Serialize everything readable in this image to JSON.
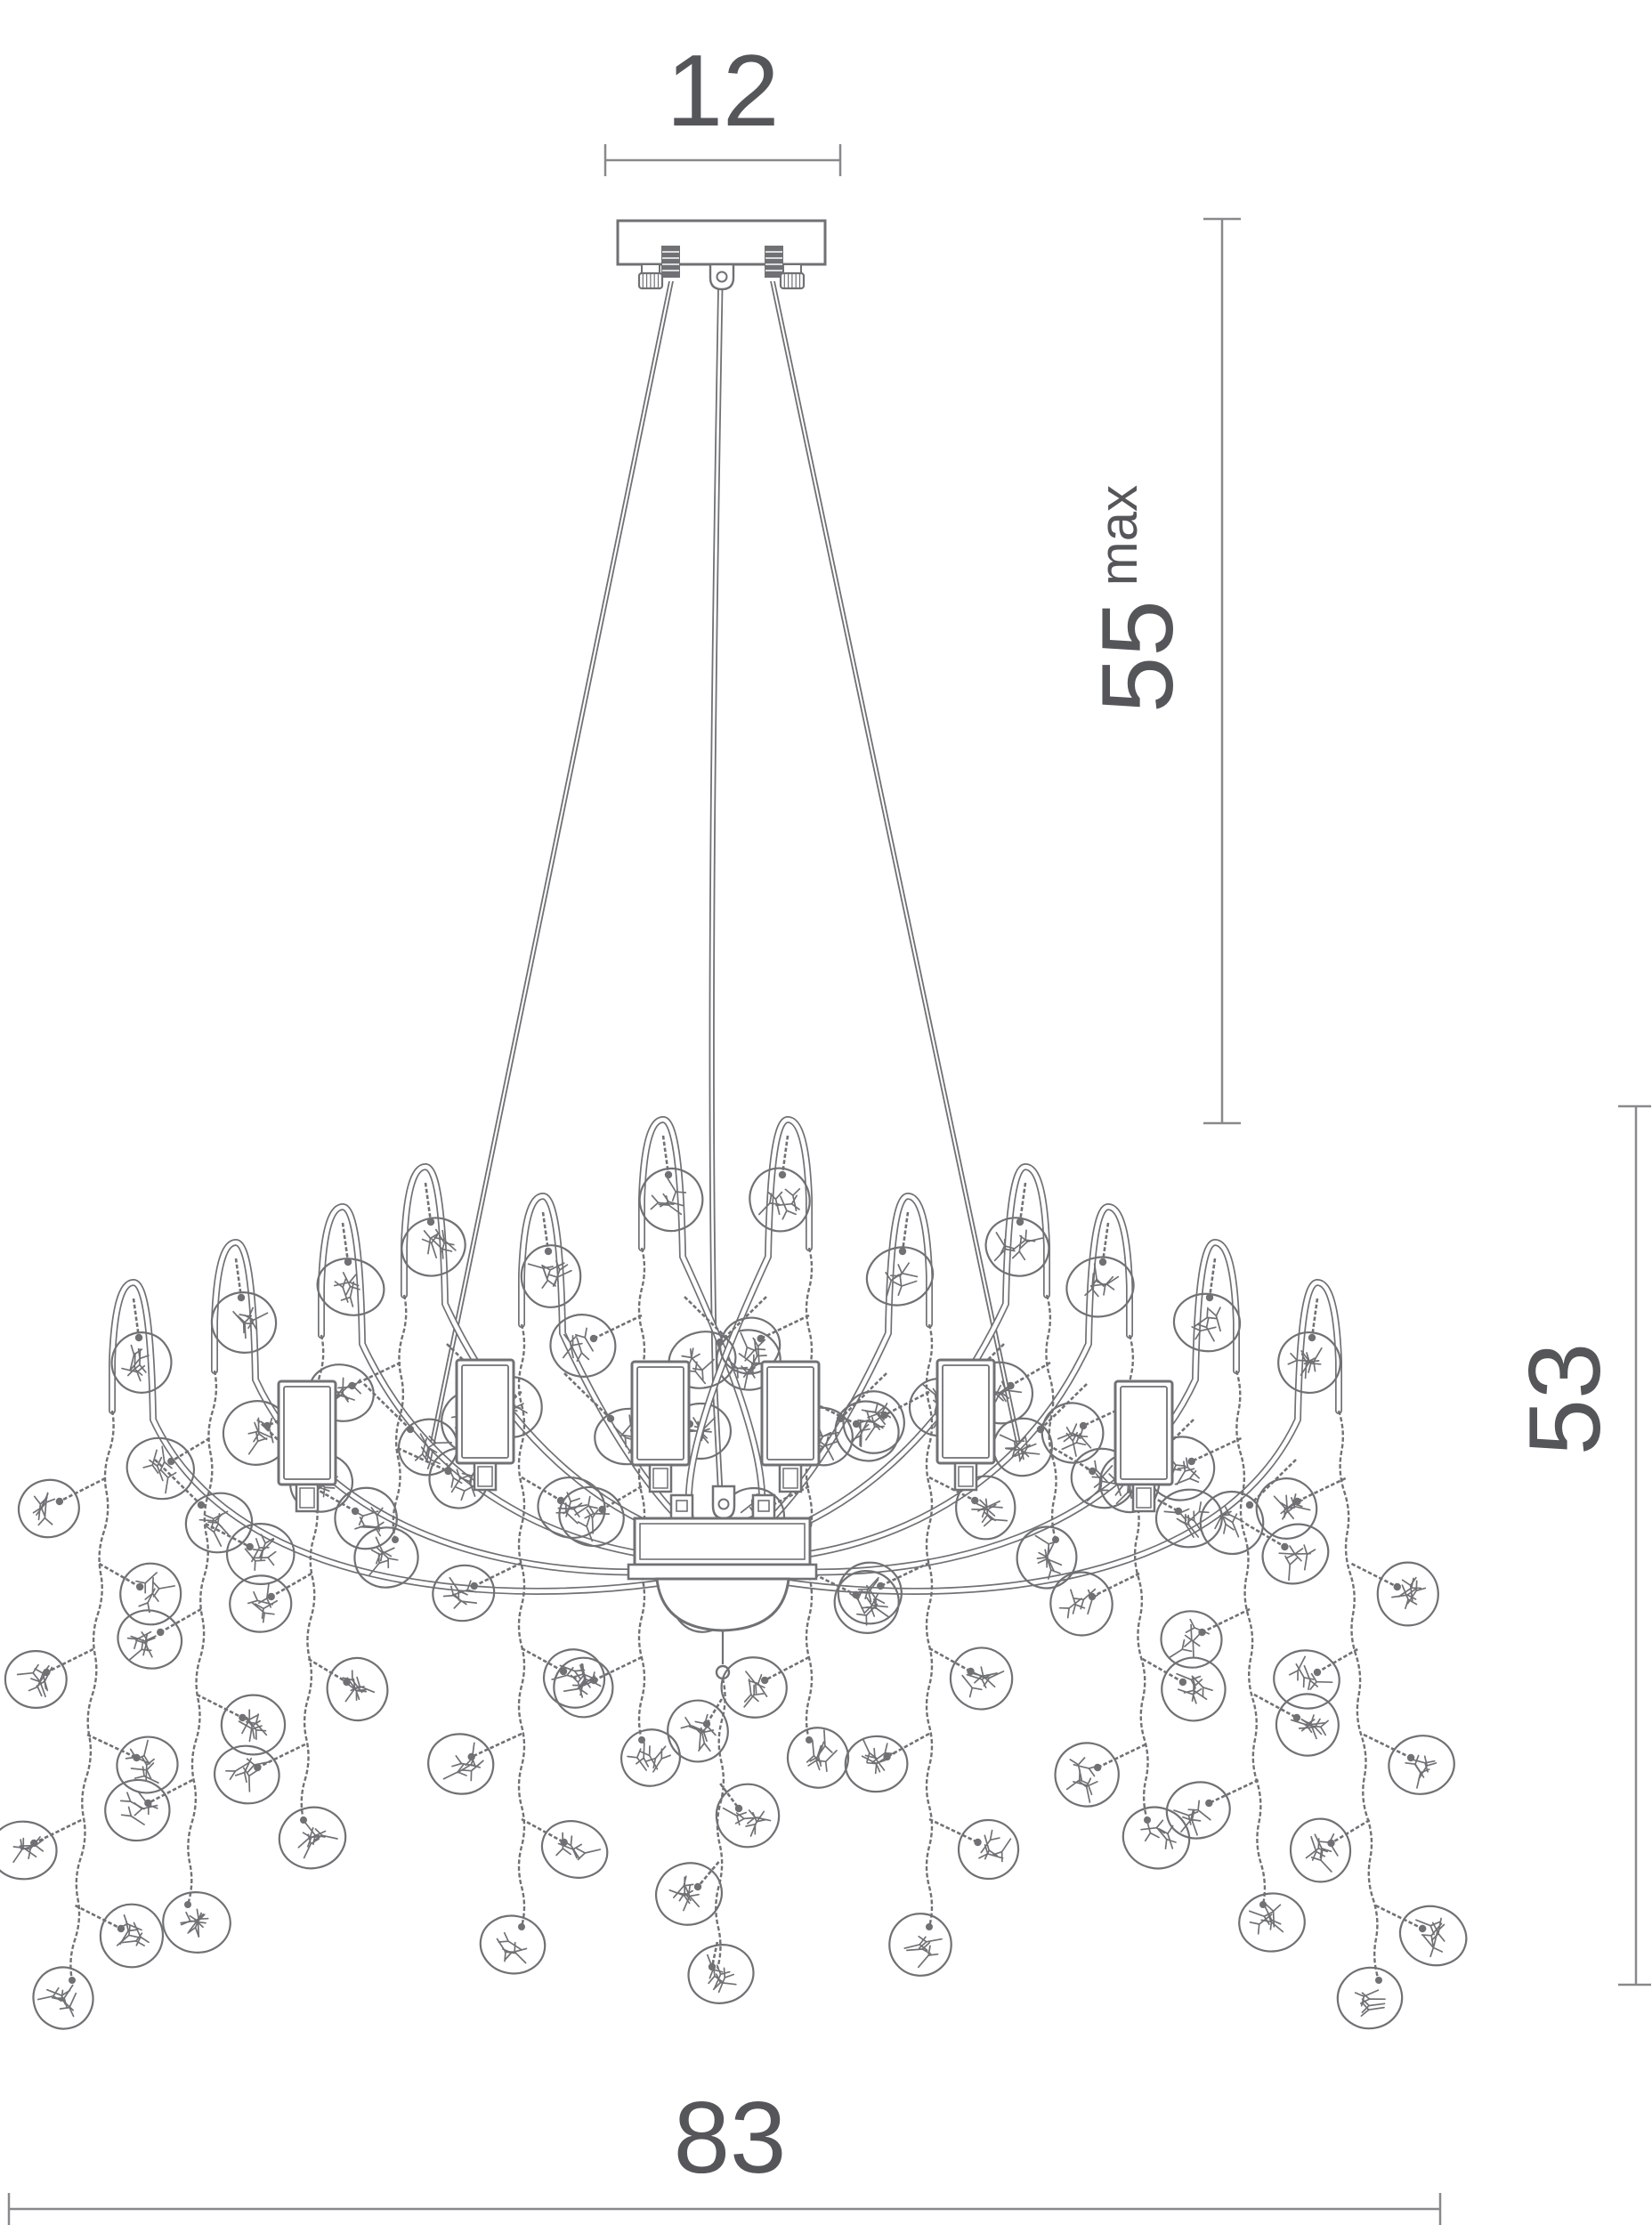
{
  "annotations": {
    "canopy_width": "12",
    "suspension_max_height": "55",
    "suspension_max_suffix": "max",
    "fixture_height": "53",
    "fixture_width": "83"
  },
  "style": {
    "line_color": "#6f7174",
    "dim_color": "#87898c",
    "label_color": "#54565a",
    "background": "#ffffff"
  }
}
